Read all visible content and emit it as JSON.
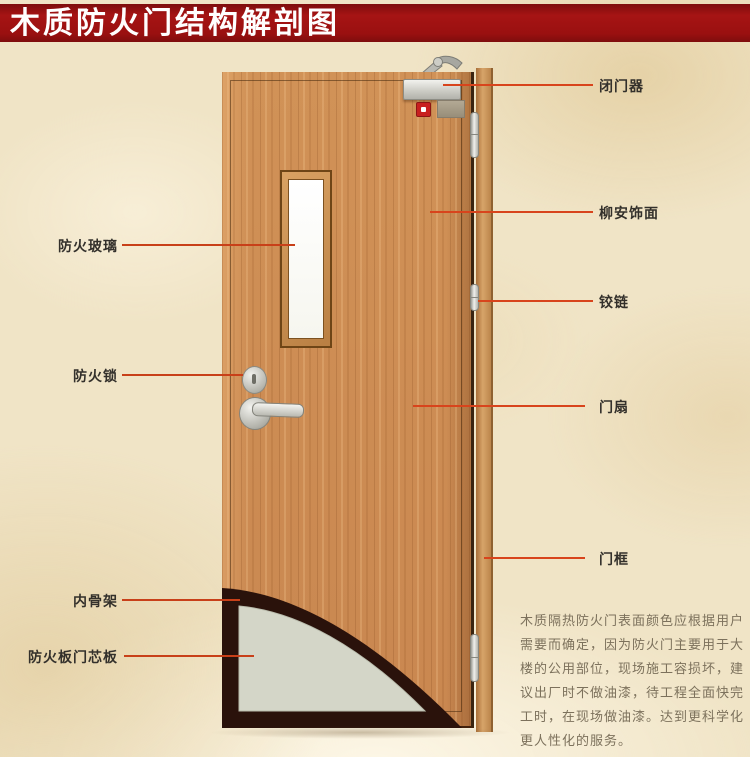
{
  "title": "木质防火门结构解剖图",
  "colors": {
    "banner_red": "#9a1010",
    "callout_red": "#c84019",
    "wood_tone": "#cd8d55",
    "frame_wood": "#c08a4e",
    "cutaway_dark": "#2a120b",
    "core_panel_gray": "#d4d6c8",
    "glass_white": "#fbfbf5",
    "label_text": "#33302b",
    "note_text": "#7c715c",
    "background_beige": "#f0e4c6"
  },
  "labels": {
    "left": [
      {
        "id": "fire-glass",
        "text": "防火玻璃"
      },
      {
        "id": "fire-lock",
        "text": "防火锁"
      },
      {
        "id": "inner-skeleton",
        "text": "内骨架"
      },
      {
        "id": "core-board",
        "text": "防火板门芯板"
      }
    ],
    "right": [
      {
        "id": "door-closer",
        "text": "闭门器"
      },
      {
        "id": "lauan-veneer",
        "text": "柳安饰面"
      },
      {
        "id": "hinge",
        "text": "铰链"
      },
      {
        "id": "door-leaf",
        "text": "门扇"
      },
      {
        "id": "door-frame",
        "text": "门框"
      }
    ]
  },
  "note": {
    "text": "木质隔热防火门表面颜色应根据用户需要而确定，因为防火门主要用于大楼的公用部位，现场施工容损坏，建议出厂时不做油漆，待工程全面快完工时，在现场做油漆。达到更科学化更人性化的服务。",
    "lines": [
      "木质隔热防火门表面颜色应根据用户",
      "需要而确定，因为防火门主要用于大",
      "楼的公用部位，现场施工容损坏，建",
      "议出厂时不做油漆，待工程全面快完",
      "工时，在现场做油漆。达到更科学化",
      "更人性化的服务。"
    ]
  }
}
